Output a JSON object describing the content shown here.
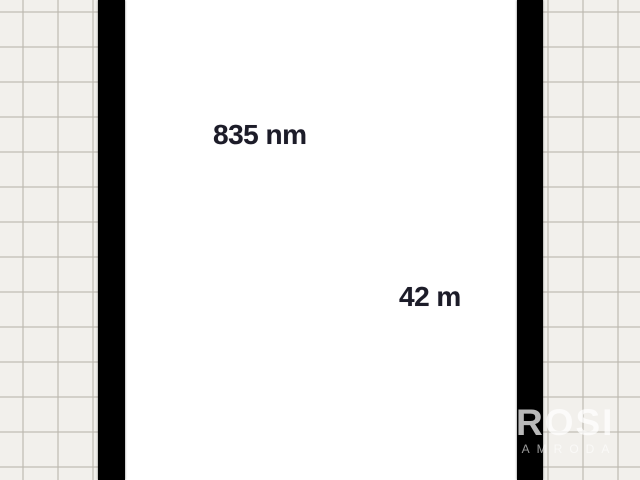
{
  "canvas": {
    "dimension_labels": [
      {
        "text": "835 nm"
      },
      {
        "text": "42 m"
      }
    ]
  },
  "watermark": {
    "title": "ROSI",
    "subtitle": "LAMRODA"
  },
  "colors": {
    "grid_background": "#f2f0ec",
    "grid_line": "#dad7d1",
    "wall": "#000000",
    "room_interior": "#ffffff",
    "label_text": "#1c1c28",
    "watermark_text": "#ffffff"
  }
}
